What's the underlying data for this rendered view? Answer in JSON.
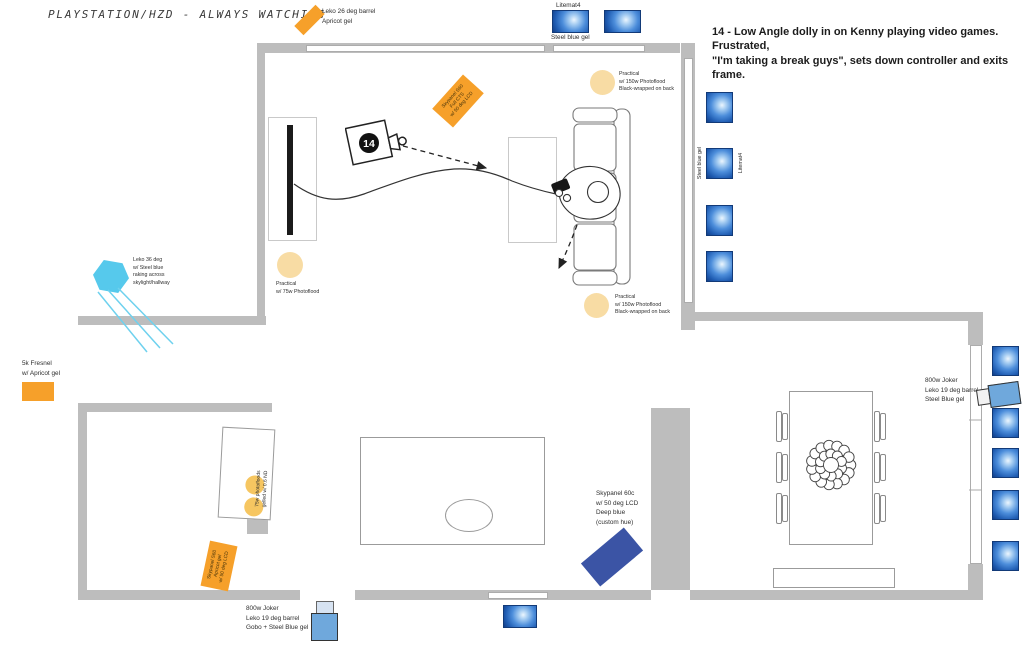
{
  "title": "PLAYSTATION/HZD - ALWAYS WATCHING",
  "scene_note": "14 - Low Angle dolly in on Kenny playing video games. Frustrated,\n\"I'm taking a break guys\", sets down controller and exits frame.",
  "camera": {
    "shot_number": "14"
  },
  "lights": {
    "leko26_label": "Leko 26 deg barrel\nApricot gel",
    "litemat_top": {
      "name": "Litemat4",
      "gel": "Steel blue gel"
    },
    "litemat_wall": {
      "name": "Litemat4",
      "gel": "Steel blue gel"
    },
    "skypanel_cts_label": "Skypanel S60\nFull CTS\nw/ 50 deg LCD",
    "practical_150_label": "Practical\nw/ 150w Photoflood\nBlack-wrapped on back",
    "practical_75_label": "Practical\nw/ 75w Photoflood",
    "leko36_label": "Leko 36 deg\nw/ Steel blue\nraking across\nskylight/hallway",
    "fresnel5k_label": "5k Fresnel\nw/ Apricot gel",
    "counter_photofloods_label": "75w photofloods\ngelled w/ 0.6 ND",
    "skypanel_apricot_label": "Skypanel S60\nApricot gel\nw/ 50 deg LCD",
    "joker_gobo_label": "800w Joker\nLeko 19 deg barrel\nGobo + Steel Blue gel",
    "skypanel_deep_blue_label": "Skypanel 60c\nw/ 50 deg LCD\nDeep blue\n(custom hue)",
    "joker_right_label": "800w Joker\nLeko 19 deg barrel\nSteel Blue gel"
  },
  "colors": {
    "apricot": "#F6A02A",
    "deep-blue": "#3B54A5",
    "sky-cyan": "#56C9EC",
    "practical-tan": "#F8DCA4",
    "photoflood-yellow": "#F6C661",
    "joker-blue": "#6FA8DC",
    "wall-gray": "#BDBDBD",
    "ink": "#2B2B2B"
  }
}
